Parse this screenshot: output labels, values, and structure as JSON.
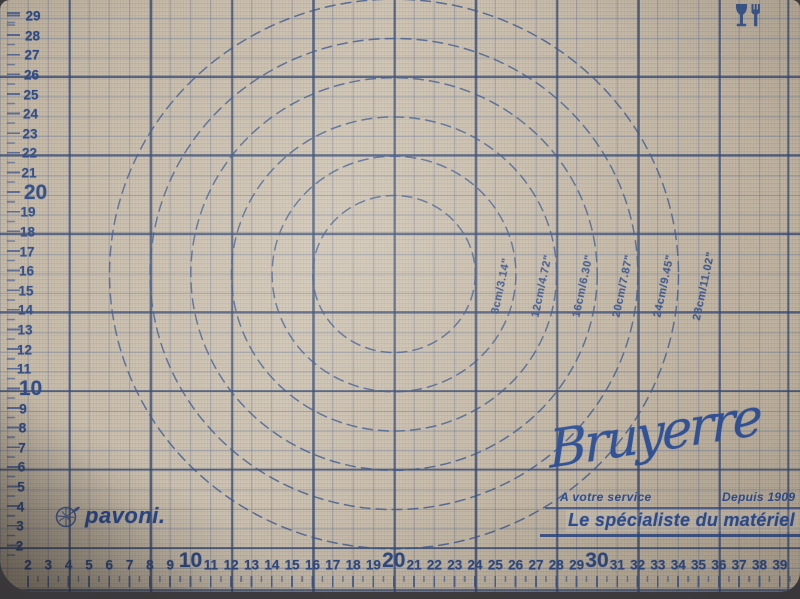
{
  "mat": {
    "left_ruler_values": [
      29,
      28,
      27,
      26,
      25,
      24,
      23,
      22,
      21,
      20,
      19,
      18,
      17,
      16,
      15,
      14,
      13,
      12,
      11,
      10,
      9,
      8,
      7,
      6,
      5,
      4,
      3,
      2
    ],
    "bottom_ruler_values": [
      2,
      3,
      4,
      5,
      6,
      7,
      8,
      9,
      10,
      11,
      12,
      13,
      14,
      15,
      16,
      17,
      18,
      19,
      20,
      21,
      22,
      23,
      24,
      25,
      26,
      27,
      28,
      29,
      30,
      31,
      32,
      33,
      34,
      35,
      36,
      37,
      38,
      39
    ],
    "circle_rings": [
      {
        "diameter_cm": 8,
        "label": "8cm/3.14\""
      },
      {
        "diameter_cm": 12,
        "label": "12cm/4.72\""
      },
      {
        "diameter_cm": 16,
        "label": "16cm/6.30\""
      },
      {
        "diameter_cm": 20,
        "label": "20cm/7.87\""
      },
      {
        "diameter_cm": 24,
        "label": "24cm/9.45\""
      },
      {
        "diameter_cm": 28,
        "label": "28cm/11.02\""
      }
    ],
    "branding": {
      "pavoni_logo_text": "pavoni.",
      "signature_text": "Bruyerre",
      "service_text": "A votre service",
      "established_text": "Depuis 1909",
      "tagline_text": "Le spécialiste du matériel"
    },
    "icons": {
      "food_safe": "wine-glass-fork-icon",
      "pavoni_emblem": "pavoni-emblem-icon"
    },
    "colors": {
      "mat_base": "#c8bcaa",
      "ink_navy": "#2e4b86",
      "grid_minor": "#7d90ad",
      "grid_major": "#43608f",
      "background": "#3a383a"
    }
  }
}
